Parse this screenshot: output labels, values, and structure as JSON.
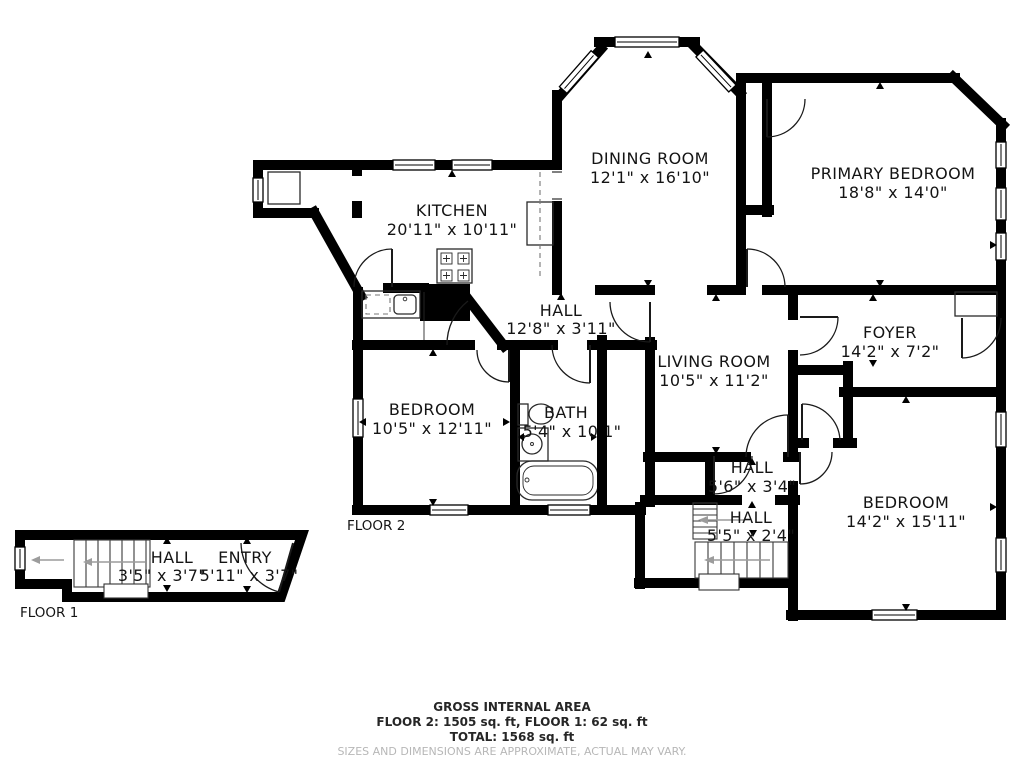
{
  "colors": {
    "wall": "#000000",
    "background": "#ffffff",
    "text": "#141414",
    "muted": "#b7b7b7"
  },
  "floor2": {
    "label": "FLOOR 2",
    "rooms": {
      "kitchen": {
        "name": "KITCHEN",
        "dims": "20'11\" x 10'11\""
      },
      "dining_room": {
        "name": "DINING ROOM",
        "dims": "12'1\" x 16'10\""
      },
      "primary_bedroom": {
        "name": "PRIMARY BEDROOM",
        "dims": "18'8\" x 14'0\""
      },
      "hall": {
        "name": "HALL",
        "dims": "12'8\" x 3'11\""
      },
      "living_room": {
        "name": "LIVING ROOM",
        "dims": "10'5\" x 11'2\""
      },
      "foyer": {
        "name": "FOYER",
        "dims": "14'2\" x 7'2\""
      },
      "bedroom_left": {
        "name": "BEDROOM",
        "dims": "10'5\" x 12'11\""
      },
      "bath": {
        "name": "BATH",
        "dims": "5'4\" x 10'1\""
      },
      "hall_upper": {
        "name": "HALL",
        "dims": "5'6\" x 3'4\""
      },
      "hall_stairs": {
        "name": "HALL",
        "dims": "5'5\" x 2'4\""
      },
      "bedroom_right": {
        "name": "BEDROOM",
        "dims": "14'2\" x 15'11\""
      }
    }
  },
  "floor1": {
    "label": "FLOOR 1",
    "rooms": {
      "hall": {
        "name": "HALL",
        "dims": "3'5\" x 3'7\""
      },
      "entry": {
        "name": "ENTRY",
        "dims": "5'11\" x 3'7\""
      }
    }
  },
  "footer": {
    "title": "GROSS INTERNAL AREA",
    "floors": "FLOOR 2: 1505 sq. ft, FLOOR 1: 62 sq. ft",
    "total": "TOTAL: 1568 sq. ft",
    "disclaimer": "SIZES AND DIMENSIONS ARE APPROXIMATE, ACTUAL MAY VARY."
  }
}
